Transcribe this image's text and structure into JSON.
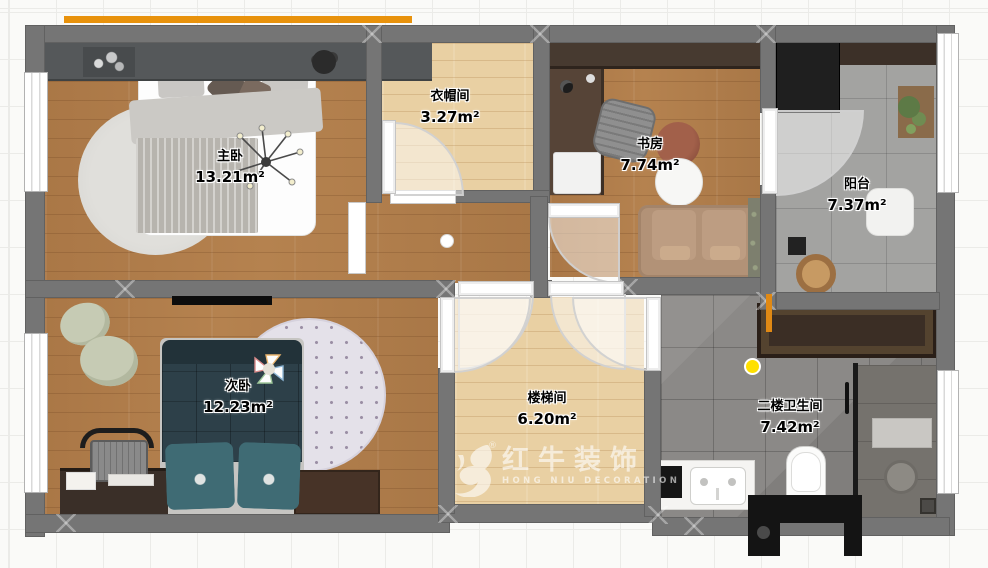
{
  "meta": {
    "canvas_width": 988,
    "canvas_height": 568,
    "view": "2F furnished floor plan, top-down render"
  },
  "floorplan": {
    "rooms": [
      {
        "id": "master-bedroom",
        "label": "主卧",
        "area": "13.21m²"
      },
      {
        "id": "cloakroom",
        "label": "衣帽间",
        "area": "3.27m²"
      },
      {
        "id": "study",
        "label": "书房",
        "area": "7.74m²"
      },
      {
        "id": "balcony",
        "label": "阳台",
        "area": "7.37m²"
      },
      {
        "id": "second-bedroom",
        "label": "次卧",
        "area": "12.23m²"
      },
      {
        "id": "stairwell",
        "label": "楼梯间",
        "area": "6.20m²"
      },
      {
        "id": "bathroom-2f",
        "label": "二楼卫生间",
        "area": "7.42m²"
      }
    ],
    "watermark": {
      "brand": "红牛装饰",
      "subtitle": "HONG NIU DECORATION",
      "registered_mark": "®"
    },
    "colors": {
      "wall": "#757575",
      "accent_orange": "#e8920c",
      "wood_mid": "#b5824f",
      "wood_light": "#e9d0a3",
      "tile_balcony": "#a3a3a1",
      "tile_bathroom": "#8b8987",
      "bed_teal": "#2d4049",
      "sofa_tan": "#b29277",
      "highlight_yellow": "#ffe000",
      "watermark_white": "rgba(255,255,255,0.6)"
    }
  }
}
